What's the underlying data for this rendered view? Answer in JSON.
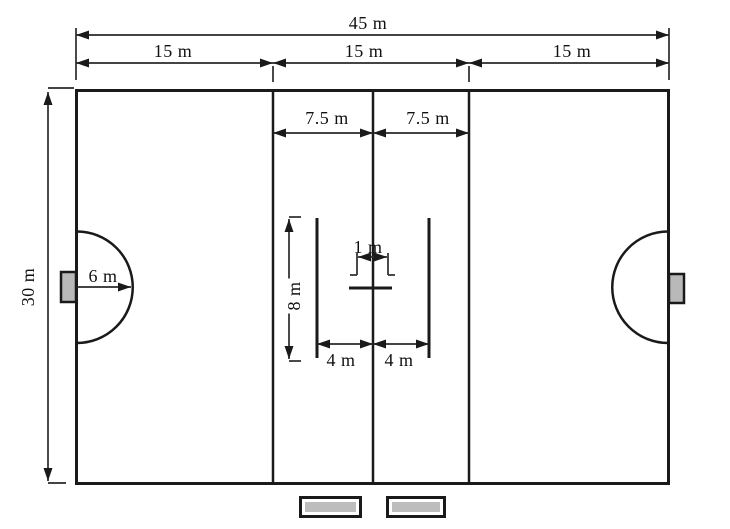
{
  "colors": {
    "line": "#1a1a1a",
    "dimension_line": "#2a2a2a",
    "goal_fill": "#b9b9b9",
    "bench_fill": "#bdbdbd",
    "background": "#ffffff"
  },
  "dimensions": {
    "total_width": "45 m",
    "section_width_1": "15 m",
    "section_width_2": "15 m",
    "section_width_3": "15 m",
    "half_section_1": "7.5 m",
    "half_section_2": "7.5 m",
    "field_height": "30 m",
    "arc_radius": "6 m",
    "center_line_height": "8 m",
    "goal_width": "1 m",
    "center_offset_left": "4 m",
    "center_offset_right": "4 m"
  }
}
